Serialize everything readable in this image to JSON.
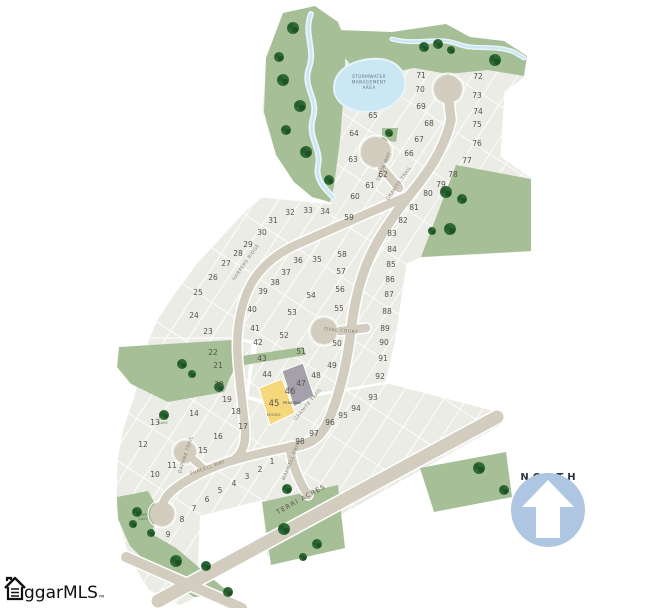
{
  "map": {
    "north_label": "NORTH",
    "logo": {
      "text": "ggarMLS",
      "tm": "™"
    },
    "stormwater_label": {
      "lines": [
        "STORMWATER",
        "MANAGEMENT",
        "AREA"
      ],
      "x": 369,
      "y": 78
    },
    "tree_save_labels": [
      {
        "text": "TREE SAVE",
        "x": 163,
        "y": 420
      },
      {
        "text": "TREE SAVE",
        "x": 143,
        "y": 516
      }
    ],
    "streets": [
      {
        "name": "TETON WAY",
        "x": 385,
        "y": 167,
        "rot": -68,
        "major": false
      },
      {
        "name": "GRANITE TRAIL",
        "x": 400,
        "y": 184,
        "rot": -55,
        "major": false
      },
      {
        "name": "HARPERS RIDGE",
        "x": 247,
        "y": 263,
        "rot": -55,
        "major": false
      },
      {
        "name": "OVAL COURT",
        "x": 341,
        "y": 332,
        "rot": 6,
        "major": false
      },
      {
        "name": "GRANITE TRAIL",
        "x": 309,
        "y": 405,
        "rot": -50,
        "major": false
      },
      {
        "name": "MAXWELL DRIVE",
        "x": 293,
        "y": 460,
        "rot": -68,
        "major": false
      },
      {
        "name": "PURCELL WAY",
        "x": 208,
        "y": 469,
        "rot": -20,
        "major": false
      },
      {
        "name": "DAPHNE TRAIL",
        "x": 187,
        "y": 455,
        "rot": -72,
        "major": false
      },
      {
        "name": "TERRI ACRES",
        "x": 302,
        "y": 501,
        "rot": -29,
        "major": true
      }
    ],
    "special_lots": [
      {
        "n": "45",
        "label": "MODEL",
        "x": 274,
        "y": 416,
        "fill": "#F5D87B"
      },
      {
        "n": "46",
        "label": "PENDING",
        "x": 292,
        "y": 404,
        "fill": "#A4A1AA"
      }
    ],
    "lots": [
      {
        "n": "1",
        "x": 272,
        "y": 464
      },
      {
        "n": "2",
        "x": 260,
        "y": 472
      },
      {
        "n": "3",
        "x": 247,
        "y": 479
      },
      {
        "n": "4",
        "x": 234,
        "y": 486
      },
      {
        "n": "5",
        "x": 220,
        "y": 493
      },
      {
        "n": "6",
        "x": 207,
        "y": 502
      },
      {
        "n": "7",
        "x": 194,
        "y": 511
      },
      {
        "n": "8",
        "x": 182,
        "y": 522
      },
      {
        "n": "9",
        "x": 168,
        "y": 537
      },
      {
        "n": "10",
        "x": 155,
        "y": 477
      },
      {
        "n": "11",
        "x": 172,
        "y": 468
      },
      {
        "n": "12",
        "x": 143,
        "y": 447
      },
      {
        "n": "13",
        "x": 155,
        "y": 425
      },
      {
        "n": "14",
        "x": 194,
        "y": 416
      },
      {
        "n": "15",
        "x": 203,
        "y": 453
      },
      {
        "n": "16",
        "x": 218,
        "y": 439
      },
      {
        "n": "17",
        "x": 243,
        "y": 429
      },
      {
        "n": "18",
        "x": 236,
        "y": 414
      },
      {
        "n": "19",
        "x": 227,
        "y": 402
      },
      {
        "n": "20",
        "x": 219,
        "y": 387
      },
      {
        "n": "21",
        "x": 218,
        "y": 368
      },
      {
        "n": "22",
        "x": 213,
        "y": 355
      },
      {
        "n": "23",
        "x": 208,
        "y": 334
      },
      {
        "n": "24",
        "x": 194,
        "y": 318
      },
      {
        "n": "25",
        "x": 198,
        "y": 295
      },
      {
        "n": "26",
        "x": 213,
        "y": 280
      },
      {
        "n": "27",
        "x": 226,
        "y": 266
      },
      {
        "n": "28",
        "x": 238,
        "y": 256
      },
      {
        "n": "29",
        "x": 248,
        "y": 247
      },
      {
        "n": "30",
        "x": 262,
        "y": 235
      },
      {
        "n": "31",
        "x": 273,
        "y": 223
      },
      {
        "n": "32",
        "x": 290,
        "y": 215
      },
      {
        "n": "33",
        "x": 308,
        "y": 213
      },
      {
        "n": "34",
        "x": 325,
        "y": 214
      },
      {
        "n": "35",
        "x": 317,
        "y": 262
      },
      {
        "n": "36",
        "x": 298,
        "y": 263
      },
      {
        "n": "37",
        "x": 286,
        "y": 275
      },
      {
        "n": "38",
        "x": 275,
        "y": 285
      },
      {
        "n": "39",
        "x": 263,
        "y": 294
      },
      {
        "n": "40",
        "x": 252,
        "y": 312
      },
      {
        "n": "41",
        "x": 255,
        "y": 331
      },
      {
        "n": "42",
        "x": 258,
        "y": 345
      },
      {
        "n": "43",
        "x": 262,
        "y": 361
      },
      {
        "n": "44",
        "x": 267,
        "y": 377
      },
      {
        "n": "45",
        "x": 274,
        "y": 406
      },
      {
        "n": "46",
        "x": 290,
        "y": 394
      },
      {
        "n": "47",
        "x": 301,
        "y": 386
      },
      {
        "n": "48",
        "x": 316,
        "y": 378
      },
      {
        "n": "49",
        "x": 332,
        "y": 368
      },
      {
        "n": "50",
        "x": 337,
        "y": 346
      },
      {
        "n": "51",
        "x": 301,
        "y": 354
      },
      {
        "n": "52",
        "x": 284,
        "y": 338
      },
      {
        "n": "53",
        "x": 292,
        "y": 315
      },
      {
        "n": "54",
        "x": 311,
        "y": 298
      },
      {
        "n": "55",
        "x": 339,
        "y": 311
      },
      {
        "n": "56",
        "x": 340,
        "y": 292
      },
      {
        "n": "57",
        "x": 341,
        "y": 274
      },
      {
        "n": "58",
        "x": 342,
        "y": 257
      },
      {
        "n": "59",
        "x": 349,
        "y": 220
      },
      {
        "n": "60",
        "x": 355,
        "y": 199
      },
      {
        "n": "61",
        "x": 370,
        "y": 188
      },
      {
        "n": "62",
        "x": 383,
        "y": 177
      },
      {
        "n": "63",
        "x": 353,
        "y": 162
      },
      {
        "n": "64",
        "x": 354,
        "y": 136
      },
      {
        "n": "65",
        "x": 373,
        "y": 118
      },
      {
        "n": "66",
        "x": 409,
        "y": 156
      },
      {
        "n": "67",
        "x": 419,
        "y": 142
      },
      {
        "n": "68",
        "x": 429,
        "y": 126
      },
      {
        "n": "69",
        "x": 421,
        "y": 109
      },
      {
        "n": "70",
        "x": 420,
        "y": 92
      },
      {
        "n": "71",
        "x": 421,
        "y": 78
      },
      {
        "n": "72",
        "x": 478,
        "y": 79
      },
      {
        "n": "73",
        "x": 477,
        "y": 98
      },
      {
        "n": "74",
        "x": 478,
        "y": 114
      },
      {
        "n": "75",
        "x": 477,
        "y": 127
      },
      {
        "n": "76",
        "x": 477,
        "y": 146
      },
      {
        "n": "77",
        "x": 467,
        "y": 163
      },
      {
        "n": "78",
        "x": 453,
        "y": 177
      },
      {
        "n": "79",
        "x": 441,
        "y": 187
      },
      {
        "n": "80",
        "x": 428,
        "y": 196
      },
      {
        "n": "81",
        "x": 414,
        "y": 210
      },
      {
        "n": "82",
        "x": 403,
        "y": 223
      },
      {
        "n": "83",
        "x": 392,
        "y": 236
      },
      {
        "n": "84",
        "x": 392,
        "y": 252
      },
      {
        "n": "85",
        "x": 391,
        "y": 267
      },
      {
        "n": "86",
        "x": 390,
        "y": 282
      },
      {
        "n": "87",
        "x": 389,
        "y": 297
      },
      {
        "n": "88",
        "x": 387,
        "y": 314
      },
      {
        "n": "89",
        "x": 385,
        "y": 331
      },
      {
        "n": "90",
        "x": 384,
        "y": 345
      },
      {
        "n": "91",
        "x": 383,
        "y": 361
      },
      {
        "n": "92",
        "x": 380,
        "y": 379
      },
      {
        "n": "93",
        "x": 373,
        "y": 400
      },
      {
        "n": "94",
        "x": 356,
        "y": 411
      },
      {
        "n": "95",
        "x": 343,
        "y": 418
      },
      {
        "n": "96",
        "x": 330,
        "y": 425
      },
      {
        "n": "97",
        "x": 314,
        "y": 436
      },
      {
        "n": "98",
        "x": 300,
        "y": 444
      }
    ],
    "colors": {
      "green": "#A6BF96",
      "tree": "#2D6A35",
      "tree_dark": "#1F5128",
      "road": "#D2CDBF",
      "lot": "#ECECE6",
      "water": "#CBE7F4",
      "lot_model": "#F5D87B",
      "lot_pending": "#A4A1AA",
      "north_blue": "#AFC6E2"
    }
  }
}
